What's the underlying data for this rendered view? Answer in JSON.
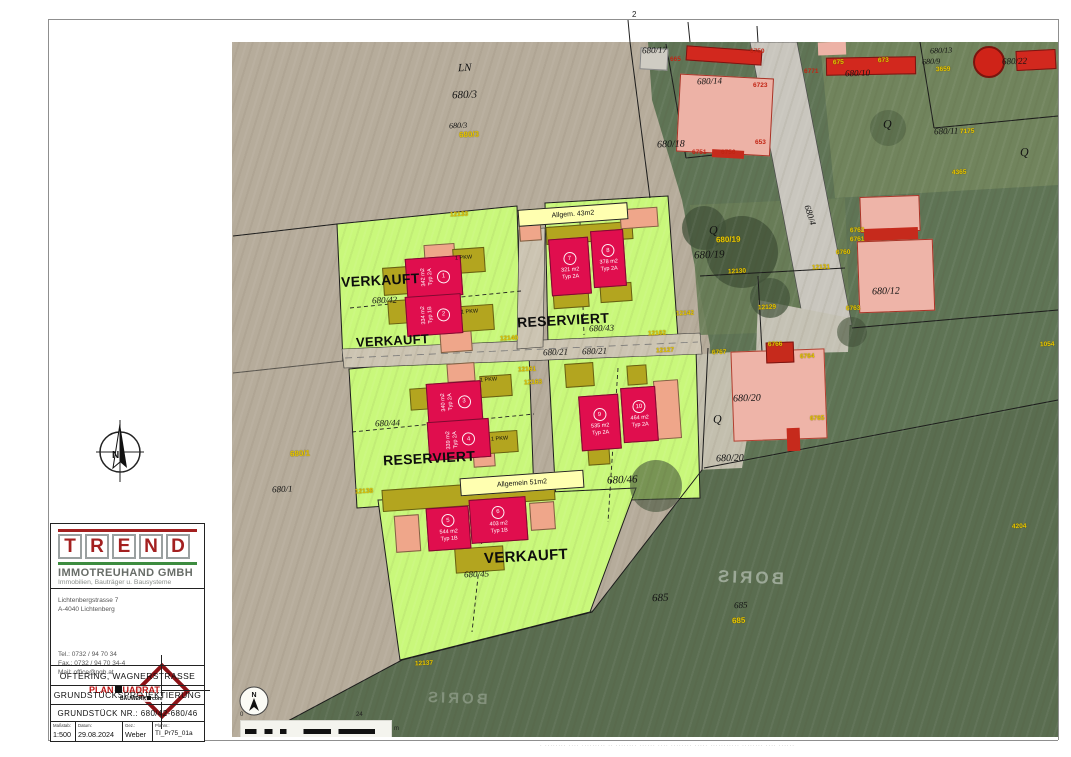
{
  "titleblock": {
    "letters": [
      "T",
      "R",
      "E",
      "N",
      "D"
    ],
    "company": "IMMOTREUHAND GMBH",
    "tagline": "Immobilien, Bauträger u. Bausysteme",
    "addr1": "Lichtenbergstrasse 7",
    "addr2": "A-4040 Lichtenberg",
    "tel": "Tel.: 0732 / 94 70 34",
    "fax": "Fax.: 0732 / 94 70 34-4",
    "mail": "Mail: office@pqb.at",
    "logo": {
      "left": "PLAN",
      "right": "UADRAT",
      "sub_left": "BAUWERK",
      "sub_right": "com"
    },
    "row_project": "OFTERING, WAGNERSTRASSE",
    "row_type": "GRUNDSTÜCKSPROJEKTIERUNG",
    "row_parcels": "GRUNDSTÜCK NR.: 680/42-680/46",
    "meta": {
      "scale_label": "Maßstab:",
      "scale": "1:500",
      "date_label": "Datum:",
      "date": "29.08.2024",
      "drawn_label": "Gez.:",
      "drawn": "Weber",
      "plan_label": "Plannr.:",
      "plan": "TI_Pr75_01a"
    }
  },
  "compass": {
    "letter": "N"
  },
  "photo": {
    "north": "N",
    "scalebar": {
      "zero": "0",
      "end": "24",
      "unit": "m"
    },
    "watermark": "BORIS",
    "status": [
      "VERKAUFT",
      "VERKAUFT",
      "RESERVIERT",
      "RESERVIERT",
      "VERKAUFT"
    ],
    "areas": {
      "a43": "Allgem. 43m2",
      "a51": "Allgemein 51m2",
      "pkw": "1 PKW"
    },
    "buildings": [
      {
        "no": "1",
        "area": "342 m2",
        "typ": "Typ 2A"
      },
      {
        "no": "2",
        "area": "334 m2",
        "typ": "Typ 1B"
      },
      {
        "no": "3",
        "area": "340 m2",
        "typ": "Typ 2A"
      },
      {
        "no": "4",
        "area": "339 m2",
        "typ": "Typ 2A"
      },
      {
        "no": "5",
        "area": "544 m2",
        "typ": "Typ 1B"
      },
      {
        "no": "6",
        "area": "403 m2",
        "typ": "Typ 1B"
      },
      {
        "no": "7",
        "area": "321 m2",
        "typ": "Typ 2A"
      },
      {
        "no": "8",
        "area": "378 m2",
        "typ": "Typ 2A"
      },
      {
        "no": "9",
        "area": "535 m2",
        "typ": "Typ 2A"
      },
      {
        "no": "10",
        "area": "464 m2",
        "typ": "Typ 2A"
      }
    ],
    "labels_black": [
      "LN",
      "680/3",
      "680/3",
      "680/42",
      "680/43",
      "680/21",
      "680/21",
      "680/44",
      "680/46",
      "680/45",
      "680/1",
      "680/19",
      "680/12",
      "680/20",
      "680/20",
      "680/4",
      "685",
      "685",
      "680/10",
      "680/13",
      "680/9",
      "680/22",
      "680/11",
      "680/17",
      "680/14",
      "680/18",
      "Q",
      "Q",
      "Q",
      "Q",
      "2"
    ],
    "labels_yellow": [
      "12133",
      "12130",
      "12131",
      "12142",
      "12129",
      "12140",
      "12162",
      "12127",
      "12161",
      "12163",
      "6762",
      "6761",
      "6760",
      "6763",
      "6767",
      "6766",
      "6764",
      "6765",
      "12138",
      "12137",
      "673",
      "675",
      "3659",
      "7175",
      "4365",
      "1054",
      "4204",
      "680/19",
      "680/1",
      "685",
      "680/3"
    ],
    "labels_red": [
      "665",
      "6750",
      "6771",
      "6723",
      "6751",
      "6756",
      "653"
    ]
  },
  "fineprint": "· ········ ···· ········· ·· ········ ······ ···· ········ ····· ··········· ········ ···· ······"
}
